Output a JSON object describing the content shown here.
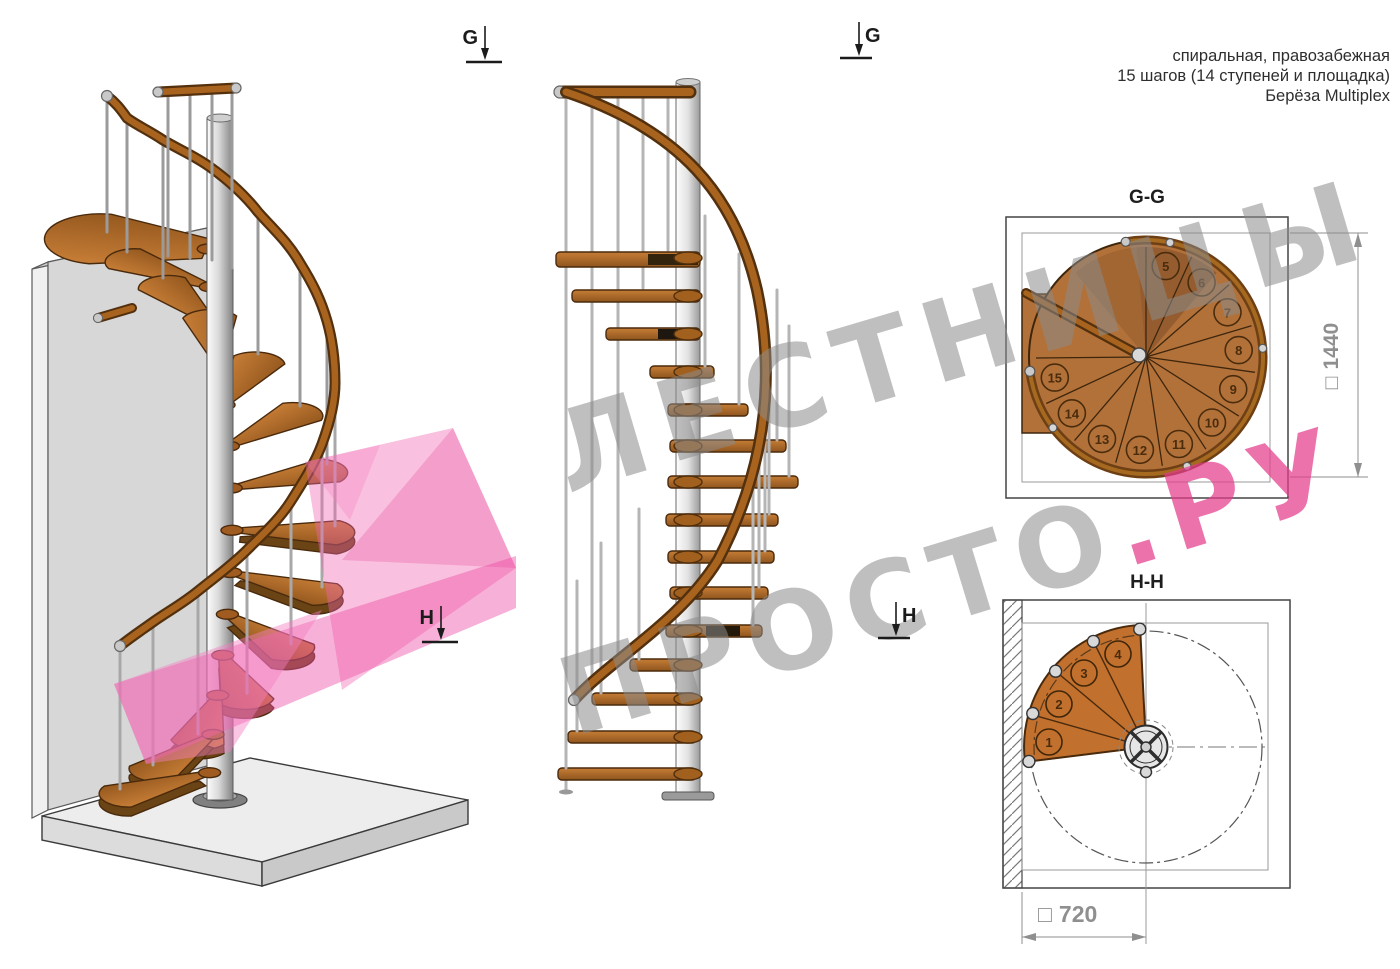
{
  "header": {
    "lines": [
      "спиральная, правозабежная",
      "15 шагов (14 ступеней и площадка)",
      "Берёза Multiplex"
    ]
  },
  "watermark": {
    "line1": "ЛЕСТНИЦЫ",
    "line2_gray": "ПРОСТО",
    "line2_pink": ".РУ"
  },
  "markers": {
    "g": "G",
    "h": "H"
  },
  "plan_gg": {
    "label": "G-G",
    "dim_symbol": "□",
    "dim_value": "1440",
    "steps": [
      "5",
      "6",
      "7",
      "8",
      "9",
      "10",
      "11",
      "12",
      "13",
      "14",
      "15"
    ]
  },
  "plan_hh": {
    "label": "H-H",
    "dim_symbol": "□",
    "dim_value": "720",
    "steps": [
      "1",
      "2",
      "3",
      "4"
    ]
  },
  "colors": {
    "wood": "#b3713a",
    "wood_dark": "#6b4416",
    "rail": "#a8641f",
    "rail_edge": "#53300e",
    "metal": "#c8c8c8",
    "wall": "#d7d7d7",
    "pink_plane": "#f05fae",
    "watermark_gray": "#8a8a8a",
    "watermark_pink": "#e83e8a",
    "dim_gray": "#8f8f8f"
  }
}
